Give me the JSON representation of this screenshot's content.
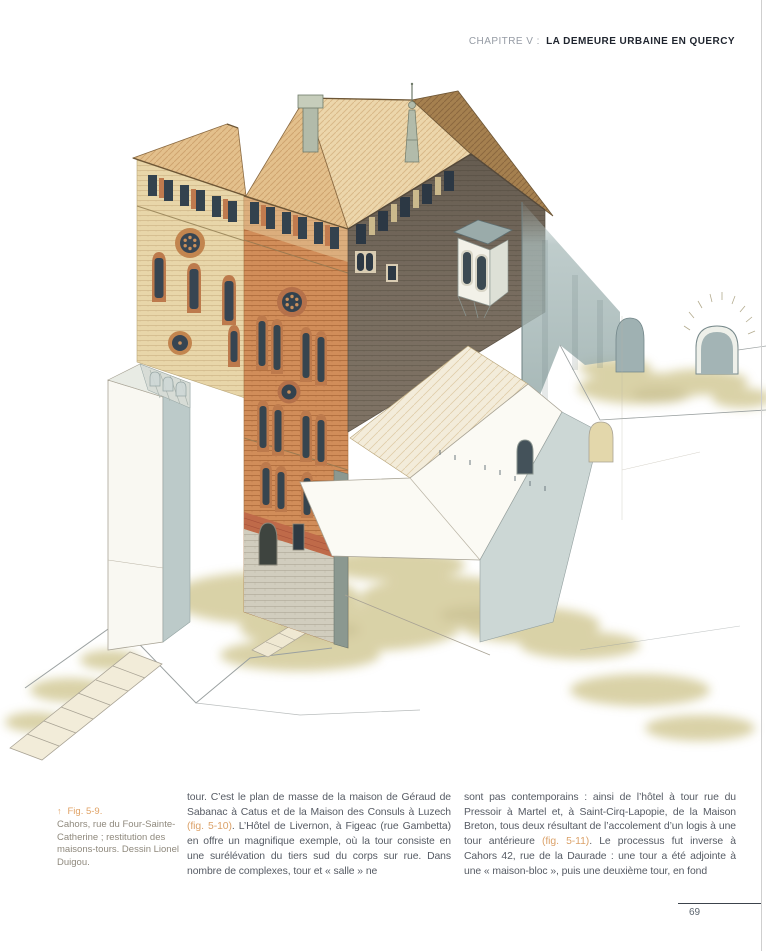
{
  "header": {
    "chapter": "CHAPITRE V :",
    "title": "LA DEMEURE URBAINE EN QUERCY"
  },
  "figure": {
    "arrow_icon": "↑",
    "label": "Fig. 5-9.",
    "caption": "Cahors, rue du Four-Sainte-Catherine ; restitution des maisons-tours. Dessin Lionel Duigou."
  },
  "body": {
    "column1": [
      {
        "t": "tour. C’est le plan de masse de la maison de Géraud de Sabanac à Catus et de la Maison des Consuls à Luzech "
      },
      {
        "t": "(fig. 5-10)",
        "accent": true
      },
      {
        "t": ". L’Hôtel de Livernon, à Figeac (rue Gambetta) en offre un magnifique exemple, où la tour consiste en une surélévation du tiers sud du corps sur rue. Dans nombre de complexes, tour et « salle » ne"
      }
    ],
    "column2": [
      {
        "t": "sont pas contemporains : ainsi de l’hôtel à tour rue du Pressoir à Martel et, à Saint-Cirq-Lapopie, de la Maison Breton, tous deux résultant de l’accolement d’un logis à une tour antérieure "
      },
      {
        "t": "(fig. 5-11)",
        "accent": true
      },
      {
        "t": ". Le processus fut inverse à Cahors 42, rue de la Daurade : une tour a été adjointe à une « maison-bloc », puis une deuxième tour, en fond"
      }
    ]
  },
  "footer": {
    "page_number": "69"
  },
  "colors": {
    "accent_orange": "#dba26a",
    "header_dark": "#1f242e",
    "header_gray": "#959ba4",
    "body_text": "#565b64",
    "caption_text": "#8f897d",
    "roof_tan": "#e3c08c",
    "brick_orange": "#d18d59",
    "brick_sand": "#e8d6a9",
    "brick_dark": "#7f7365",
    "window_dark": "#33424e",
    "wash_gray_blue": "#a9bbba",
    "ground_olive": "#cdc38a"
  }
}
